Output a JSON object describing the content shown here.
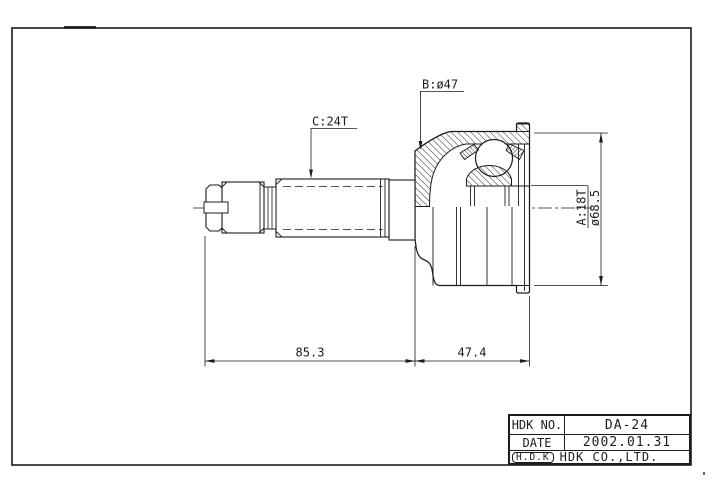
{
  "drawing": {
    "part_type": "cv-joint-outer-race-technical-drawing",
    "labels": {
      "c_spline": "C:24T",
      "b_diameter": "B:ø47",
      "a_spline": "A:18T",
      "outer_diameter": "ø68.5"
    },
    "dims": {
      "shaft_length": "85.3",
      "joint_length": "47.4"
    }
  },
  "title_block": {
    "no_label": "HDK NO.",
    "no_value": "DA-24",
    "date_label": "DATE",
    "date_value": "2002.01.31",
    "logo": "H.D.K",
    "company": "HDK CO.,LTD."
  },
  "colors": {
    "line": "#1c1c1c",
    "background": "#ffffff"
  }
}
